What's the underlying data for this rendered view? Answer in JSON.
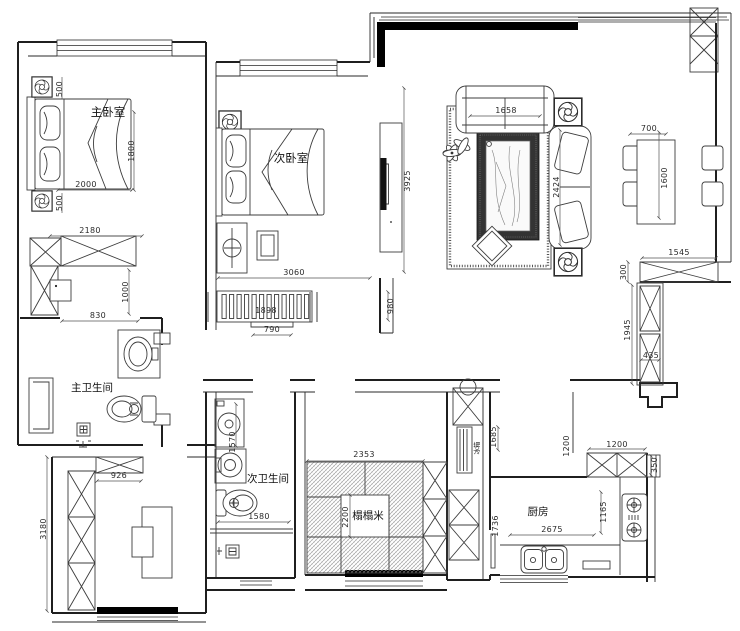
{
  "plan": {
    "rooms": {
      "master_bedroom": "主卧室",
      "second_bedroom": "次卧室",
      "master_bathroom": "主卫生间",
      "second_bathroom": "次卫生间",
      "tatami": "榻榻米",
      "kitchen": "厨房",
      "fridge": "冰箱"
    },
    "dims": {
      "ac_top": "500",
      "ac_bottom": "500",
      "bed_h": "1800",
      "bed_w": "2000",
      "closet_w": "2180",
      "closet_h": "1000",
      "bath_door": "830",
      "left_room_h": "3180",
      "left_room_w": "926",
      "bath2_h": "1570",
      "bath2_w": "1580",
      "tatami_w": "2353",
      "tatami_h": "2200",
      "bed2_w": "3060",
      "radiator": "1898",
      "radiator_w": "790",
      "tv_wall_h": "3925",
      "tv_wall_low": "980",
      "sofa_w": "1658",
      "sofa_h": "2424",
      "dining_w": "700",
      "dining_h": "1600",
      "cab_right_w": "1545",
      "cab_right_d": "300",
      "cab_tall_h": "1945",
      "cab_tall_w": "435",
      "hall_wall": "1200",
      "entry_h": "1685",
      "kitchen_cab_w": "1200",
      "kitchen_win": "350",
      "kitchen_d": "1165",
      "kitchen_w": "2675",
      "kitchen_h": "1736"
    },
    "colors": {
      "line": "#1f1f1f",
      "wall_fill": "#000000",
      "paper": "#ffffff",
      "rug_band": "#333333"
    }
  }
}
